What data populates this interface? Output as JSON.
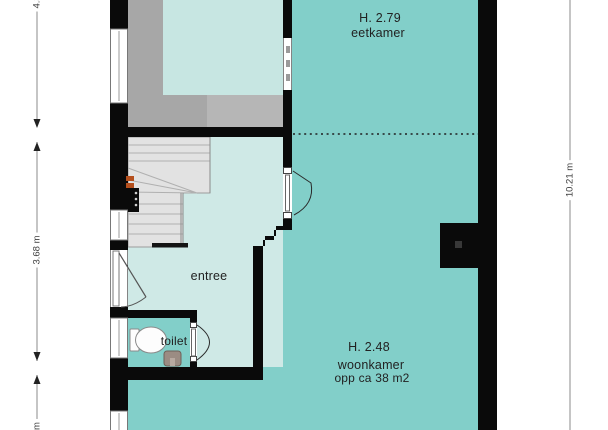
{
  "floorplan": {
    "rooms": [
      {
        "name": "eetkamer",
        "ceiling_height": "H. 2.79"
      },
      {
        "name": "woonkamer",
        "ceiling_height": "H. 2.48",
        "area": "opp ca 38 m2"
      },
      {
        "name": "entree"
      },
      {
        "name": "toilet"
      }
    ],
    "dimensions": {
      "left_top": "4.32 m",
      "left_middle": "3.68 m",
      "left_bottom_partial": "m",
      "right": "10.21 m"
    },
    "fixtures": [
      "staircase",
      "toilet-bowl",
      "hand-basin",
      "chimney",
      "meter-cabinet"
    ]
  },
  "colors": {
    "room-teal": "#82cfc9",
    "room-light": "#cfe9e6",
    "room-cyan": "#c7e6e2",
    "gray-dark": "#a7a7a7",
    "gray-light": "#b6b6b6",
    "wall": "#0a0a0a",
    "stair-fill": "#e2e2e2",
    "stair-line": "#b0b0b0",
    "dim-line": "#8b8b8b",
    "sink-brown": "#9b8c83",
    "accent-orange": "#b44f1d"
  }
}
